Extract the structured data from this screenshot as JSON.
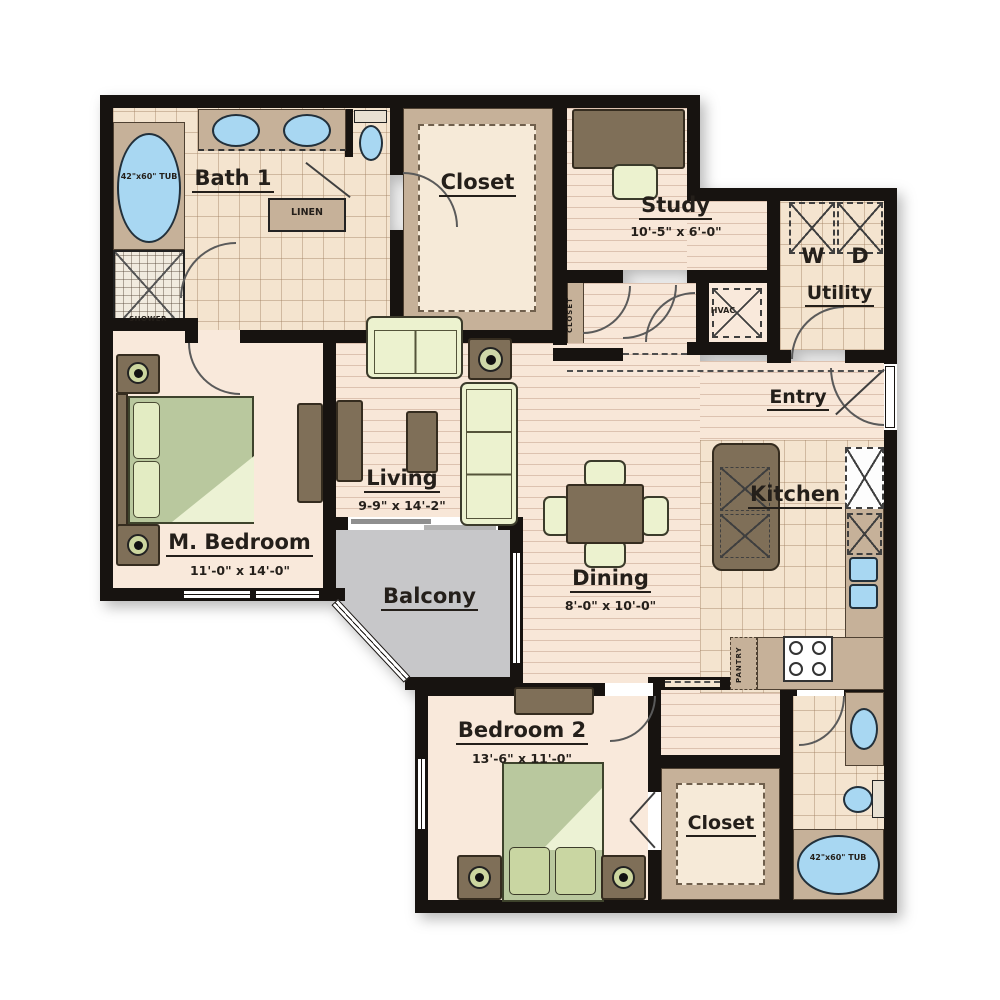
{
  "rooms": {
    "bath1": {
      "label": "Bath 1"
    },
    "closet_top": {
      "label": "Closet"
    },
    "study": {
      "label": "Study",
      "dim": "10'-5\" x 6'-0\""
    },
    "utility": {
      "label": "Utility"
    },
    "entry": {
      "label": "Entry"
    },
    "living": {
      "label": "Living",
      "dim": "9-9\" x 14'-2\""
    },
    "m_bedroom": {
      "label": "M. Bedroom",
      "dim": "11'-0\" x 14'-0\""
    },
    "balcony": {
      "label": "Balcony"
    },
    "dining": {
      "label": "Dining",
      "dim": "8'-0\" x 10'-0\""
    },
    "kitchen": {
      "label": "Kitchen"
    },
    "bedroom2": {
      "label": "Bedroom 2",
      "dim": "13'-6\" x 11'-0\""
    },
    "closet_bottom": {
      "label": "Closet"
    }
  },
  "fixtures": {
    "tub_master": "42\"x60\" TUB",
    "tub_bath2": "42\"x60\" TUB",
    "shower": "SHOWER",
    "linen": "LINEN",
    "hvac": "HVAC",
    "hall_closet": "CLOSET",
    "pantry": "PANTRY",
    "washer": "W",
    "dryer": "D"
  },
  "colors": {
    "wall": "#171310",
    "wood_floor": "#f8e7d8",
    "tile_floor": "#f4e4cf",
    "carpet": "#f9e9db",
    "balcony": "#c7c7c9",
    "furniture_brown": "#7f6f58",
    "counter_tan": "#c6b199",
    "bed_green": "#b9c89e",
    "cushion_green": "#ecf2cf",
    "fixture_blue": "#a8d7f2"
  }
}
